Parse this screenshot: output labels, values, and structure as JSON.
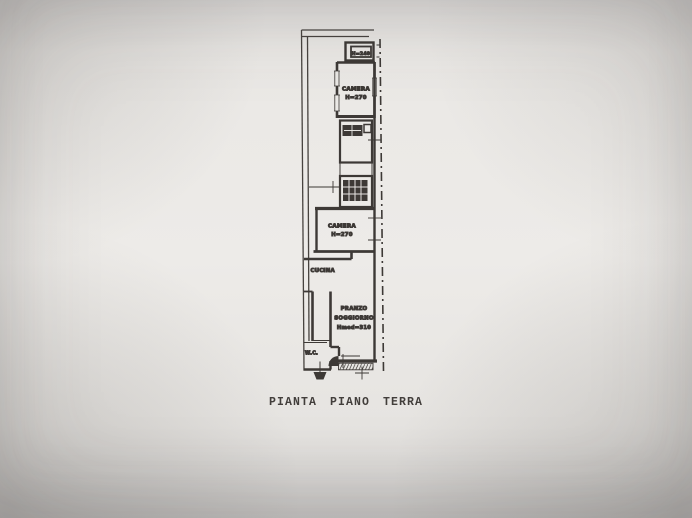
{
  "page": {
    "title": "PIANTA PIANO TERRA"
  },
  "colors": {
    "ink": "#3b3734",
    "paper": "#e9e7e4"
  },
  "plan": {
    "rooms": {
      "closet_top": {
        "label": "H=240"
      },
      "camera_1": {
        "name": "CAMERA",
        "height": "H=270"
      },
      "camera_2": {
        "name": "CAMERA",
        "height": "H=270"
      },
      "cucina": {
        "name": "CUCINA"
      },
      "pranzo_soggiorno": {
        "line1": "PRANZO",
        "line2": "SOGGIORNO",
        "line3": "Hmed=310"
      },
      "wc": {
        "name": "W.C."
      }
    }
  }
}
